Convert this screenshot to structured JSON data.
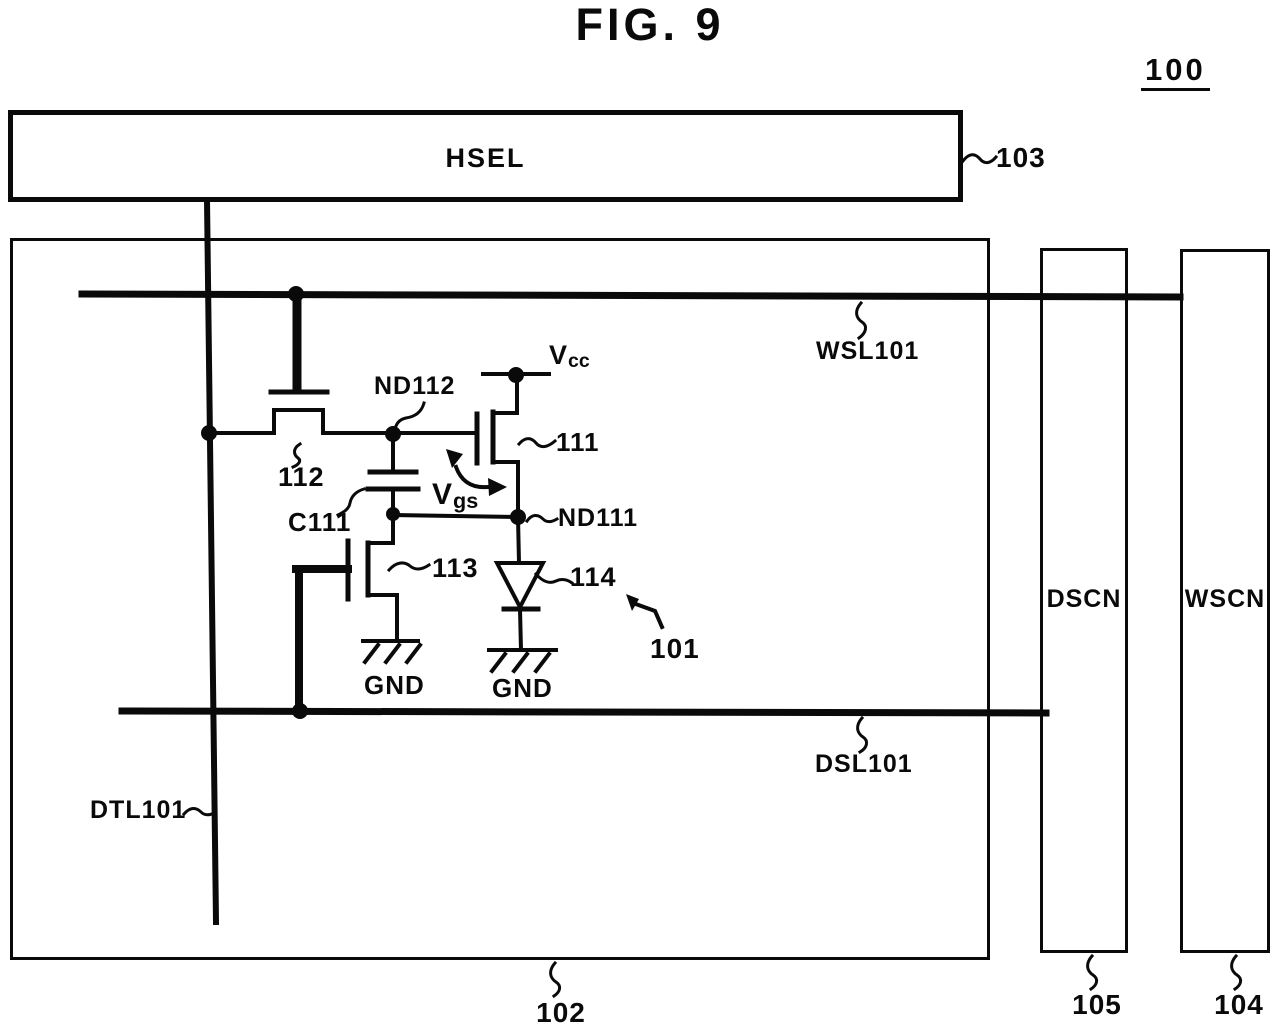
{
  "figure": {
    "title": "FIG. 9",
    "ref": "100"
  },
  "blocks": {
    "hsel": {
      "label": "HSEL",
      "ref": "103"
    },
    "pixel_array": {
      "ref": "102"
    },
    "dscn": {
      "label": "DSCN",
      "ref": "105"
    },
    "wscn": {
      "label": "WSCN",
      "ref": "104"
    }
  },
  "wires": {
    "wsl101": {
      "label": "WSL101"
    },
    "dsl101": {
      "label": "DSL101"
    },
    "dtl101": {
      "label": "DTL101"
    }
  },
  "pixel_circuit": {
    "ref": "101",
    "drive_transistor": {
      "ref": "111"
    },
    "write_transistor": {
      "ref": "112"
    },
    "switch_transistor": {
      "ref": "113"
    },
    "light_emitting_element": {
      "ref": "114"
    },
    "capacitor": {
      "ref": "C111"
    },
    "node_nd112": {
      "label": "ND112"
    },
    "node_nd111": {
      "label": "ND111"
    },
    "supply_vcc": {
      "base": "V",
      "sub": "cc"
    },
    "voltage_vgs": {
      "base": "V",
      "sub": "gs"
    },
    "ground_left": {
      "label": "GND"
    },
    "ground_right": {
      "label": "GND"
    }
  },
  "colors": {
    "ink": "#0a0a0a",
    "background": "#ffffff"
  }
}
